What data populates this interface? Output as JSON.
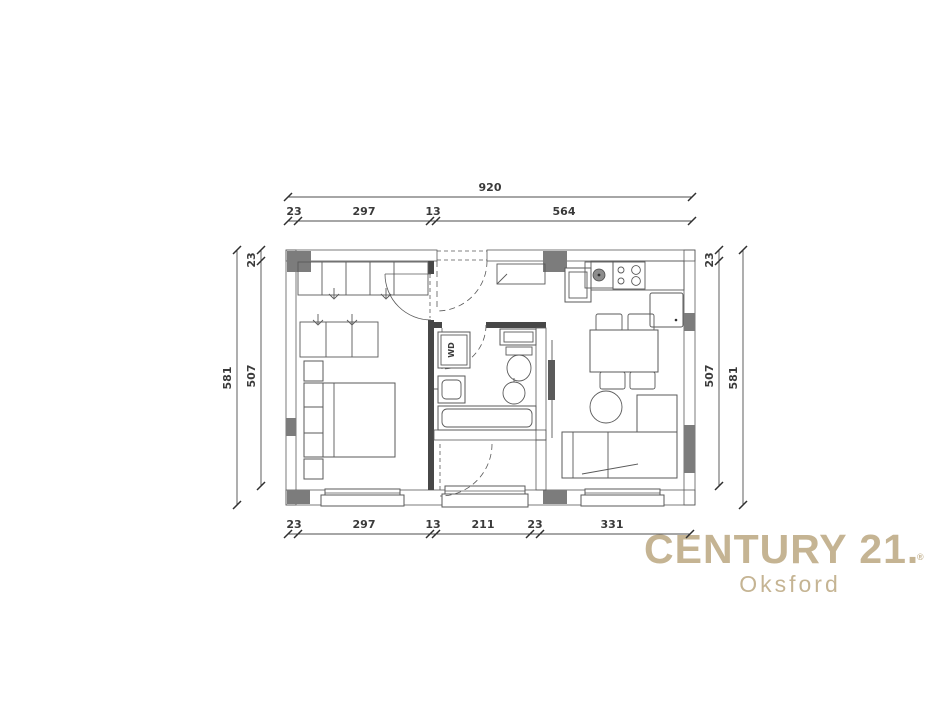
{
  "floor_plan": {
    "dimensions": {
      "top_total": "920",
      "top_segments": [
        "23",
        "297",
        "13",
        "564"
      ],
      "bottom_segments": [
        "23",
        "297",
        "13",
        "211",
        "23",
        "331"
      ],
      "left_wall": "23",
      "left_inner": "507",
      "left_outer": "581",
      "right_wall": "23",
      "right_inner": "507",
      "right_outer": "581"
    },
    "labels": {
      "washer_dryer": "WD"
    },
    "colors": {
      "line": "#4a4a4a",
      "wall_hatch_pink": "#cf9e9e",
      "wall_hatch_gray": "#8f8f8f",
      "column_gray": "#7c7c7c"
    }
  },
  "branding": {
    "brand": "CENTURY 21.",
    "registered": "®",
    "office": "Oksford",
    "brand_color": "#c5b493"
  }
}
